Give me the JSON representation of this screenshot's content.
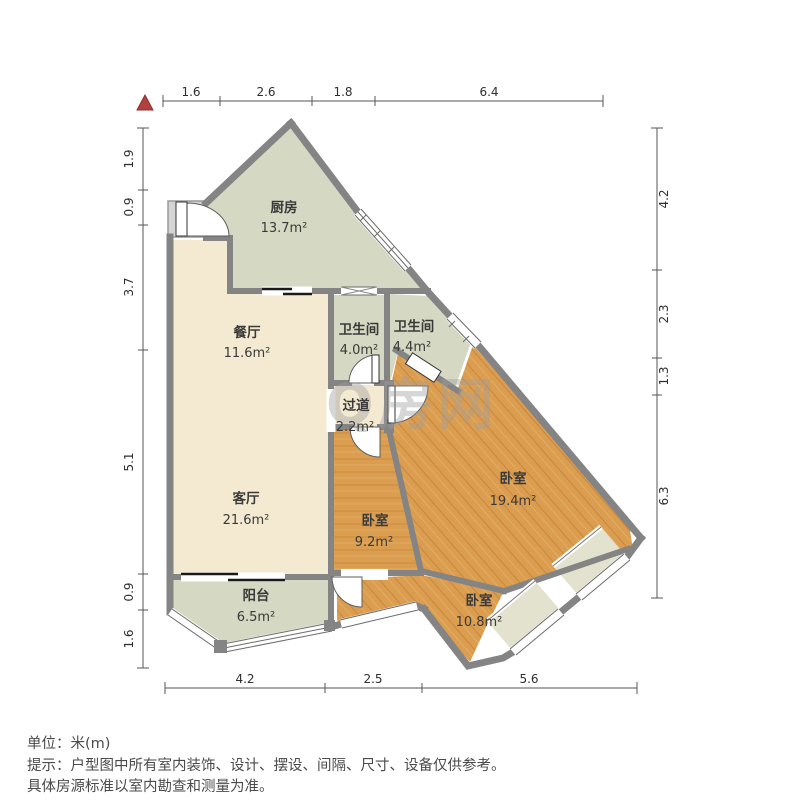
{
  "rooms": {
    "kitchen": {
      "name": "厨房",
      "area": "13.7m²"
    },
    "dining": {
      "name": "餐厅",
      "area": "11.6m²"
    },
    "bath_1": {
      "name": "卫生间",
      "area": "4.0m²"
    },
    "bath_2": {
      "name": "卫生间",
      "area": "4.4m²"
    },
    "hallway": {
      "name": "过道",
      "area": "2.2m²"
    },
    "living": {
      "name": "客厅",
      "area": "21.6m²"
    },
    "bedroom_big": {
      "name": "卧室",
      "area": "19.4m²"
    },
    "bedroom_mid": {
      "name": "卧室",
      "area": "9.2m²"
    },
    "bedroom_small": {
      "name": "卧室",
      "area": "10.8m²"
    },
    "balcony": {
      "name": "阳台",
      "area": "6.5m²"
    }
  },
  "dimensions": {
    "top": [
      "1.6",
      "2.6",
      "1.8",
      "6.4"
    ],
    "left": [
      "1.9",
      "0.9",
      "3.7",
      "5.1",
      "0.9",
      "1.6"
    ],
    "right": [
      "4.2",
      "2.3",
      "1.3",
      "6.3"
    ],
    "bottom": [
      "4.2",
      "2.5",
      "5.6"
    ]
  },
  "watermark": {
    "text": "Q房网"
  },
  "footer": {
    "unit": "单位：米(m)",
    "tip_line1": "提示：户型图中所有室内装饰、设计、摆设、间隔、尺寸、设备仅供参考。",
    "tip_line2": "具体房源标准以室内勘查和测量为准。"
  },
  "colors": {
    "wall": "#848484",
    "floor_tile": "#d5d8c2",
    "floor_bay": "#e2e2cf",
    "floor_cream": "#f4ead2",
    "floor_wood": "#db9d50",
    "north_red": "#b0413e",
    "dim_text": "#2e2e2e"
  }
}
